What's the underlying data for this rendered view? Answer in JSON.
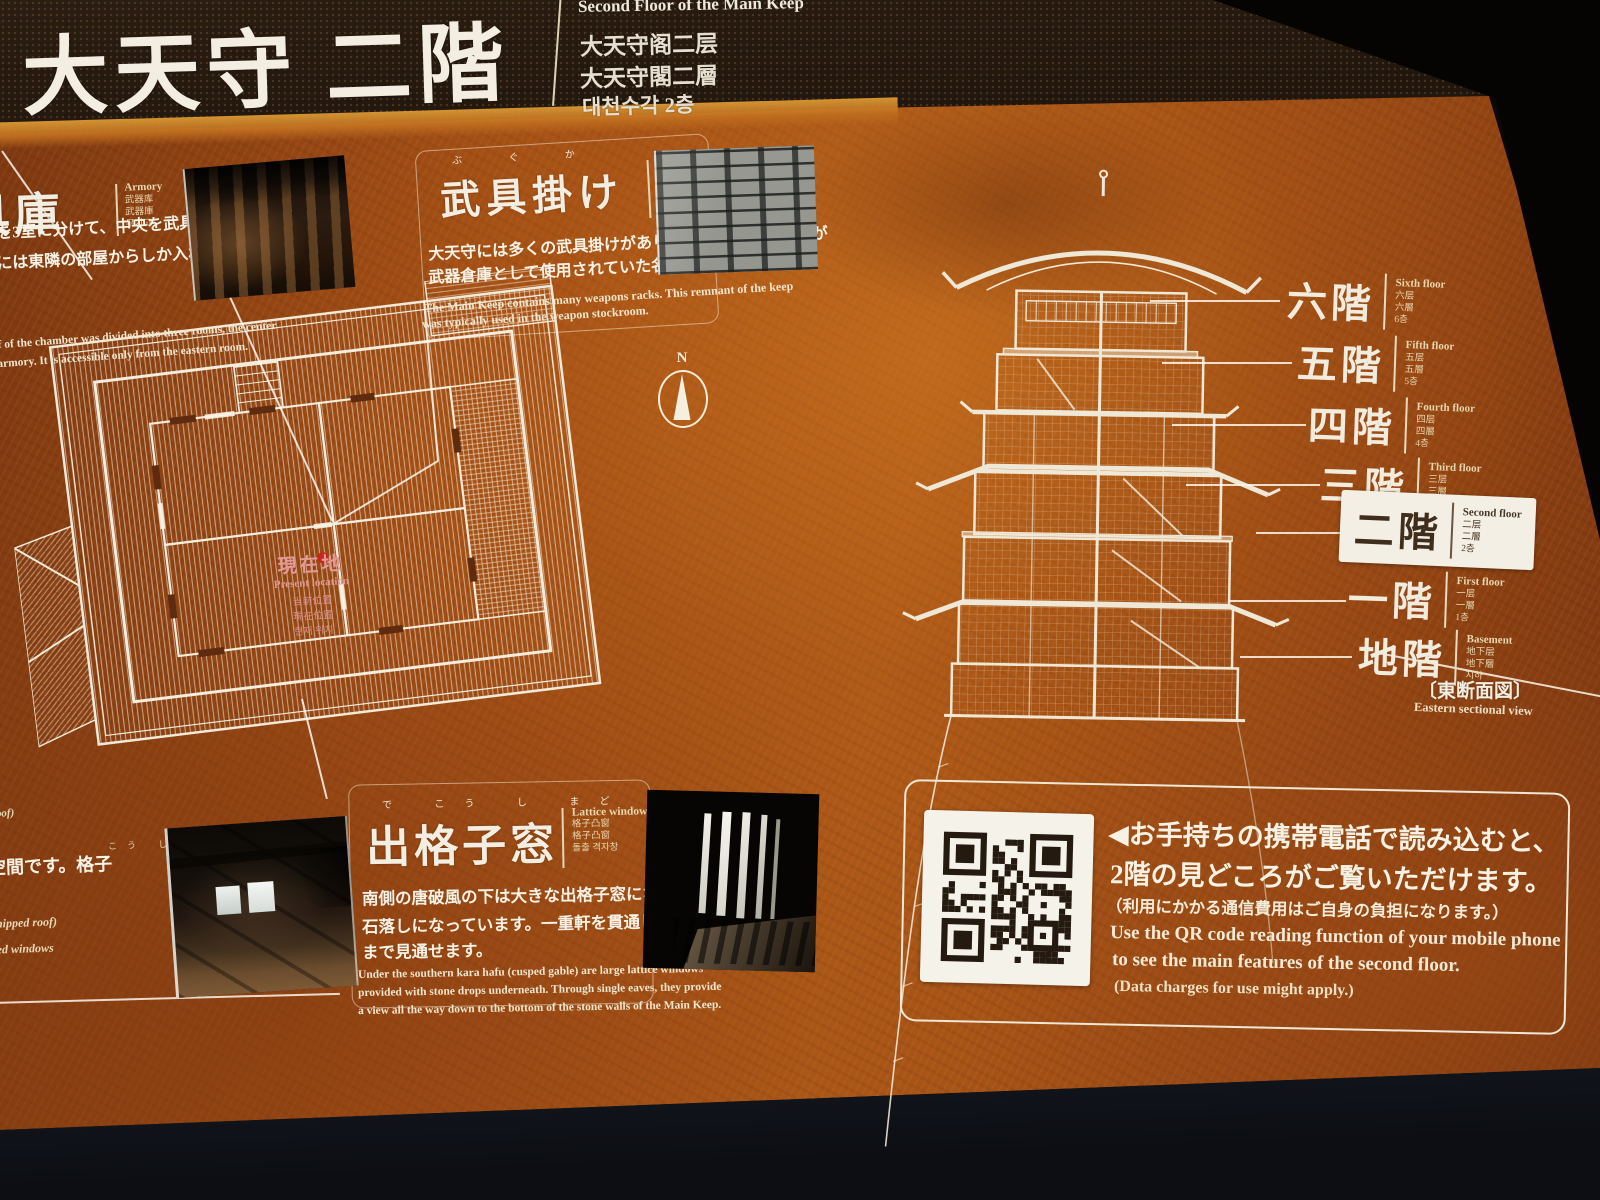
{
  "header": {
    "title_jp": "大天守 二階",
    "title_en": "Second Floor of the Main Keep",
    "title_zh_cn": "大天守阁二层",
    "title_zh_tw": "大天守閣二層",
    "title_ko": "대천수각 2층"
  },
  "sections": {
    "armory": {
      "heading_jp": "武具庫",
      "labels": {
        "en": "Armory",
        "zh_cn": "武器库",
        "zh_tw": "武器庫",
        "ko": "무기고"
      },
      "body_jp": [
        "北半分を3室に分けて、中央を武具庫としています。",
        "には東隣の部屋からしか入れないようになって"
      ],
      "body_en": [
        "half of the chamber was divided into three rooms, the center",
        "an armory. It is accessible only from the eastern room."
      ]
    },
    "weapon_racks": {
      "furigana": "ぶ ぐ か",
      "heading_jp": "武具掛け",
      "labels": {
        "en": "Weapon racks",
        "zh_cn": "武器架",
        "zh_tw": "武器架",
        "ko": "무기걸이"
      },
      "body_jp": [
        "大天守には多くの武具掛けがありました。通常、天守が",
        "武器倉庫として使用されていた名残です。"
      ],
      "body_en": [
        "The Main Keep contains many weapons racks. This remnant of the keep",
        "was typically used in the weapon stockroom."
      ]
    },
    "lattice_window": {
      "furigana": "で こう し まど",
      "heading_jp": "出格子窓",
      "labels": {
        "en": "Lattice window",
        "zh_cn": "格子凸窗",
        "zh_tw": "格子凸窗",
        "ko": "돌출 격자창"
      },
      "body_jp": [
        "南側の唐破風の下は大きな出格子窓になり、窓の下は",
        "石落しになっています。一重軒を貫通し、天守台石垣下",
        "まで見通せます。"
      ],
      "body_en": [
        "Under the southern kara hafu (cusped gable) are large lattice windows",
        "provided with stone drops underneath. Through single eaves, they provide",
        "a view all the way down to the bottom of the stone walls of the Main Keep."
      ]
    },
    "gable_fragments": {
      "f1": "破風 (gable roof)",
      "f2": "空間です。格子",
      "f2_furigana": "こう し",
      "f3": "(half-hipped roof)",
      "f4": "latticed windows"
    }
  },
  "floor_plan": {
    "marker_jp": "現在地",
    "marker_en": "Present location",
    "marker_zh_cn": "当前位置",
    "marker_zh_tw": "現在位置",
    "marker_ko": "현재 위치",
    "compass": "N"
  },
  "cross_section": {
    "floors": [
      {
        "jp": "六階",
        "en": "Sixth floor",
        "zh_cn": "六层",
        "zh_tw": "六層",
        "ko": "6층"
      },
      {
        "jp": "五階",
        "en": "Fifth floor",
        "zh_cn": "五层",
        "zh_tw": "五層",
        "ko": "5층"
      },
      {
        "jp": "四階",
        "en": "Fourth floor",
        "zh_cn": "四层",
        "zh_tw": "四層",
        "ko": "4층"
      },
      {
        "jp": "三階",
        "en": "Third floor",
        "zh_cn": "三层",
        "zh_tw": "三層",
        "ko": "3층"
      },
      {
        "jp": "二階",
        "en": "Second floor",
        "zh_cn": "二层",
        "zh_tw": "二層",
        "ko": "2층"
      },
      {
        "jp": "一階",
        "en": "First floor",
        "zh_cn": "一层",
        "zh_tw": "一層",
        "ko": "1층"
      },
      {
        "jp": "地階",
        "en": "Basement",
        "zh_cn": "地下层",
        "zh_tw": "地下層",
        "ko": "지하"
      }
    ],
    "caption_jp": "〔東断面図〕",
    "caption_en": "Eastern sectional view"
  },
  "qr": {
    "jp": [
      "◀お手持ちの携帯電話で読み込むと、",
      "2階の見どころがご覧いただけます。",
      "（利用にかかる通信費用はご自身の負担になります。）"
    ],
    "en": [
      "Use the QR code reading function of your mobile phone",
      "to see the main features of the second floor.",
      "(Data charges for use might apply.)"
    ]
  },
  "colors": {
    "panel_rust": "#a85216",
    "panel_dark": "#6f3110",
    "ink_white": "#f4eee1",
    "cream": "#e9d8b2",
    "marker_pink": "#e39a96",
    "marker_red": "#c3271e",
    "highlight_box": "#f3efe4",
    "line_art": "#f0e8d6"
  }
}
